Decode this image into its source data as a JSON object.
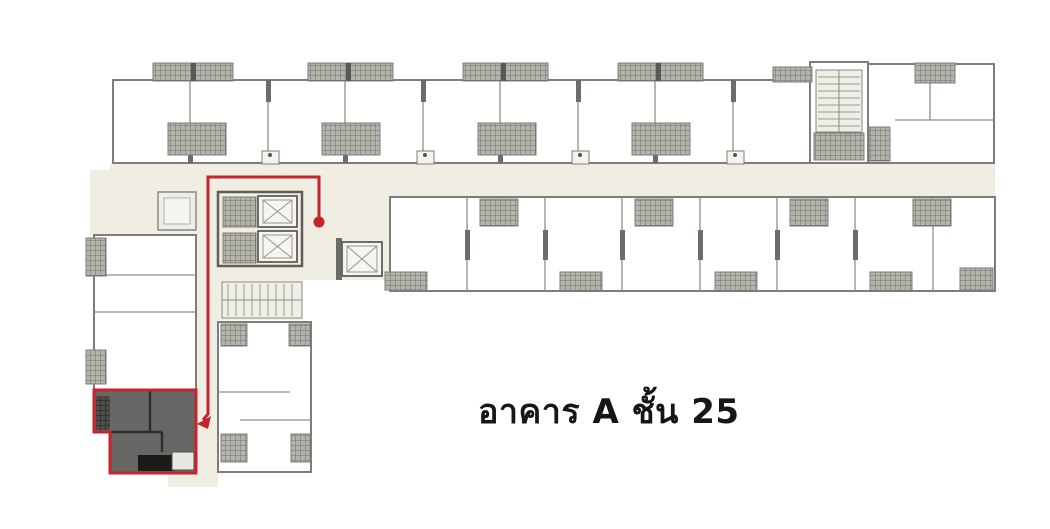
{
  "title": {
    "text": "อาคาร A ชั้น 25"
  },
  "plan": {
    "highlighted_unit": {
      "status": "selected",
      "location": "bottom-left-wing",
      "marker": "red-outline"
    },
    "route": {
      "marker_start": "red-dot",
      "marker_end": "red-arrow",
      "path": "from lift lobby along left corridor down to highlighted unit"
    }
  },
  "icons": {
    "lift": "square-with-x-icon",
    "stairs": "tread-lines-icon",
    "balcony": "crosshatch-block",
    "route_start": "red-dot",
    "route_end": "red-arrow-left"
  },
  "colors": {
    "background": "#ffffff",
    "corridor": "#f0eee2",
    "unit_top_row": "#a8a7a3",
    "unit_bottom_row": "#d6d4ca",
    "unit_left_wing": "#a5a3a0",
    "unit_lavender": "#cbcad9",
    "unit_highlighted": "#686765",
    "highlight_wall": "#2e2d2b",
    "wall": "#7e7d79",
    "balcony_hatch": "#6f6e68",
    "route_red": "#c5242c",
    "label_text": "#161616"
  }
}
